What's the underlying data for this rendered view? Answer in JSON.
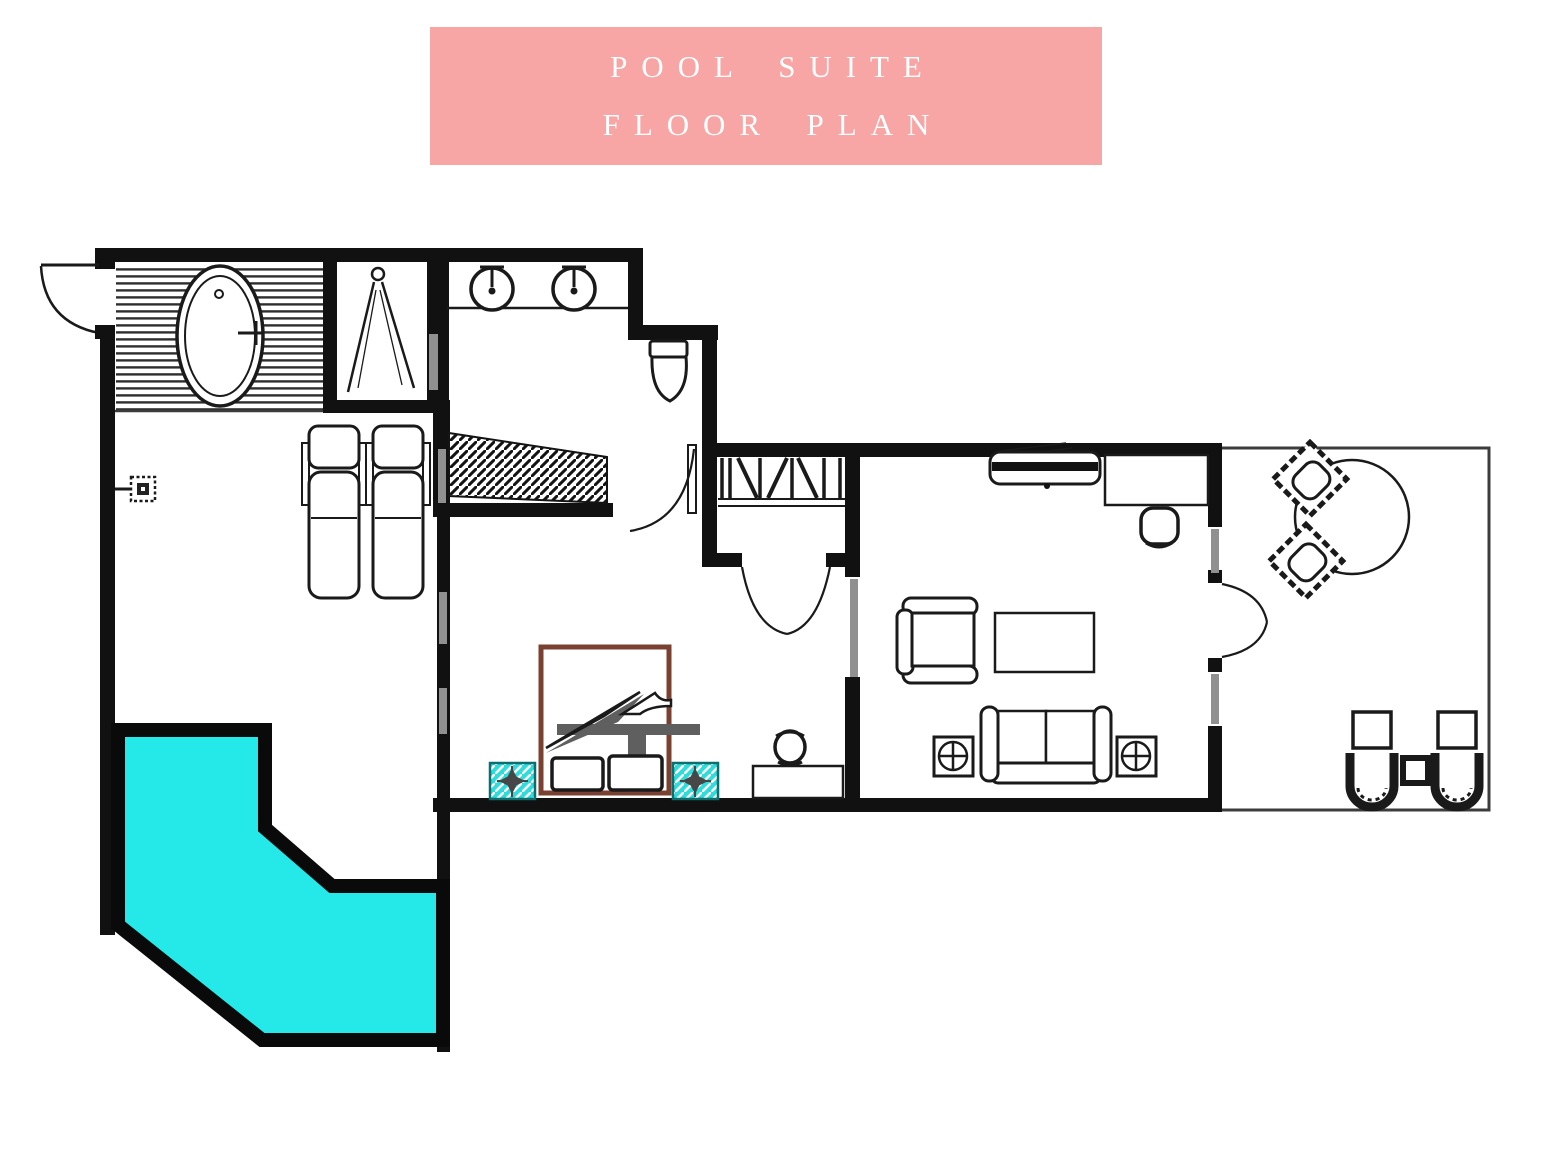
{
  "banner": {
    "line1": "POOL SUITE",
    "line2": "FLOOR PLAN"
  },
  "colors": {
    "banner_bg": "#f7a5a5",
    "banner_text": "#ffffff",
    "wall": "#111111",
    "window": "#909090",
    "line": "#1a1a1a",
    "deck_line": "#3c3c3c",
    "pool_water": "#25e8e8",
    "pool_border": "#0a0a0a",
    "bed_frame": "#7a4031",
    "blanket": "#5f5f5f",
    "nightstand": "#2edcdc"
  },
  "icons": [
    "entry-door-icon",
    "bathtub-icon",
    "shower-icon",
    "sink-icon",
    "toilet-icon",
    "ramp-hatch-icon",
    "wall-light-icon",
    "sun-lounger-icon",
    "wardrobe-hangers-icon",
    "bathroom-door-icon",
    "hall-double-door-icon",
    "bed-icon",
    "pillow-icon",
    "nightstand-icon",
    "desk-icon",
    "stool-icon",
    "tv-console-icon",
    "office-chair-icon",
    "armchair-icon",
    "coffee-table-icon",
    "sofa-icon",
    "side-table-icon",
    "balcony-door-icon",
    "outdoor-dining-table-icon",
    "deck-chair-icon",
    "deck-lounger-icon",
    "footstool-icon",
    "pool-icon"
  ]
}
